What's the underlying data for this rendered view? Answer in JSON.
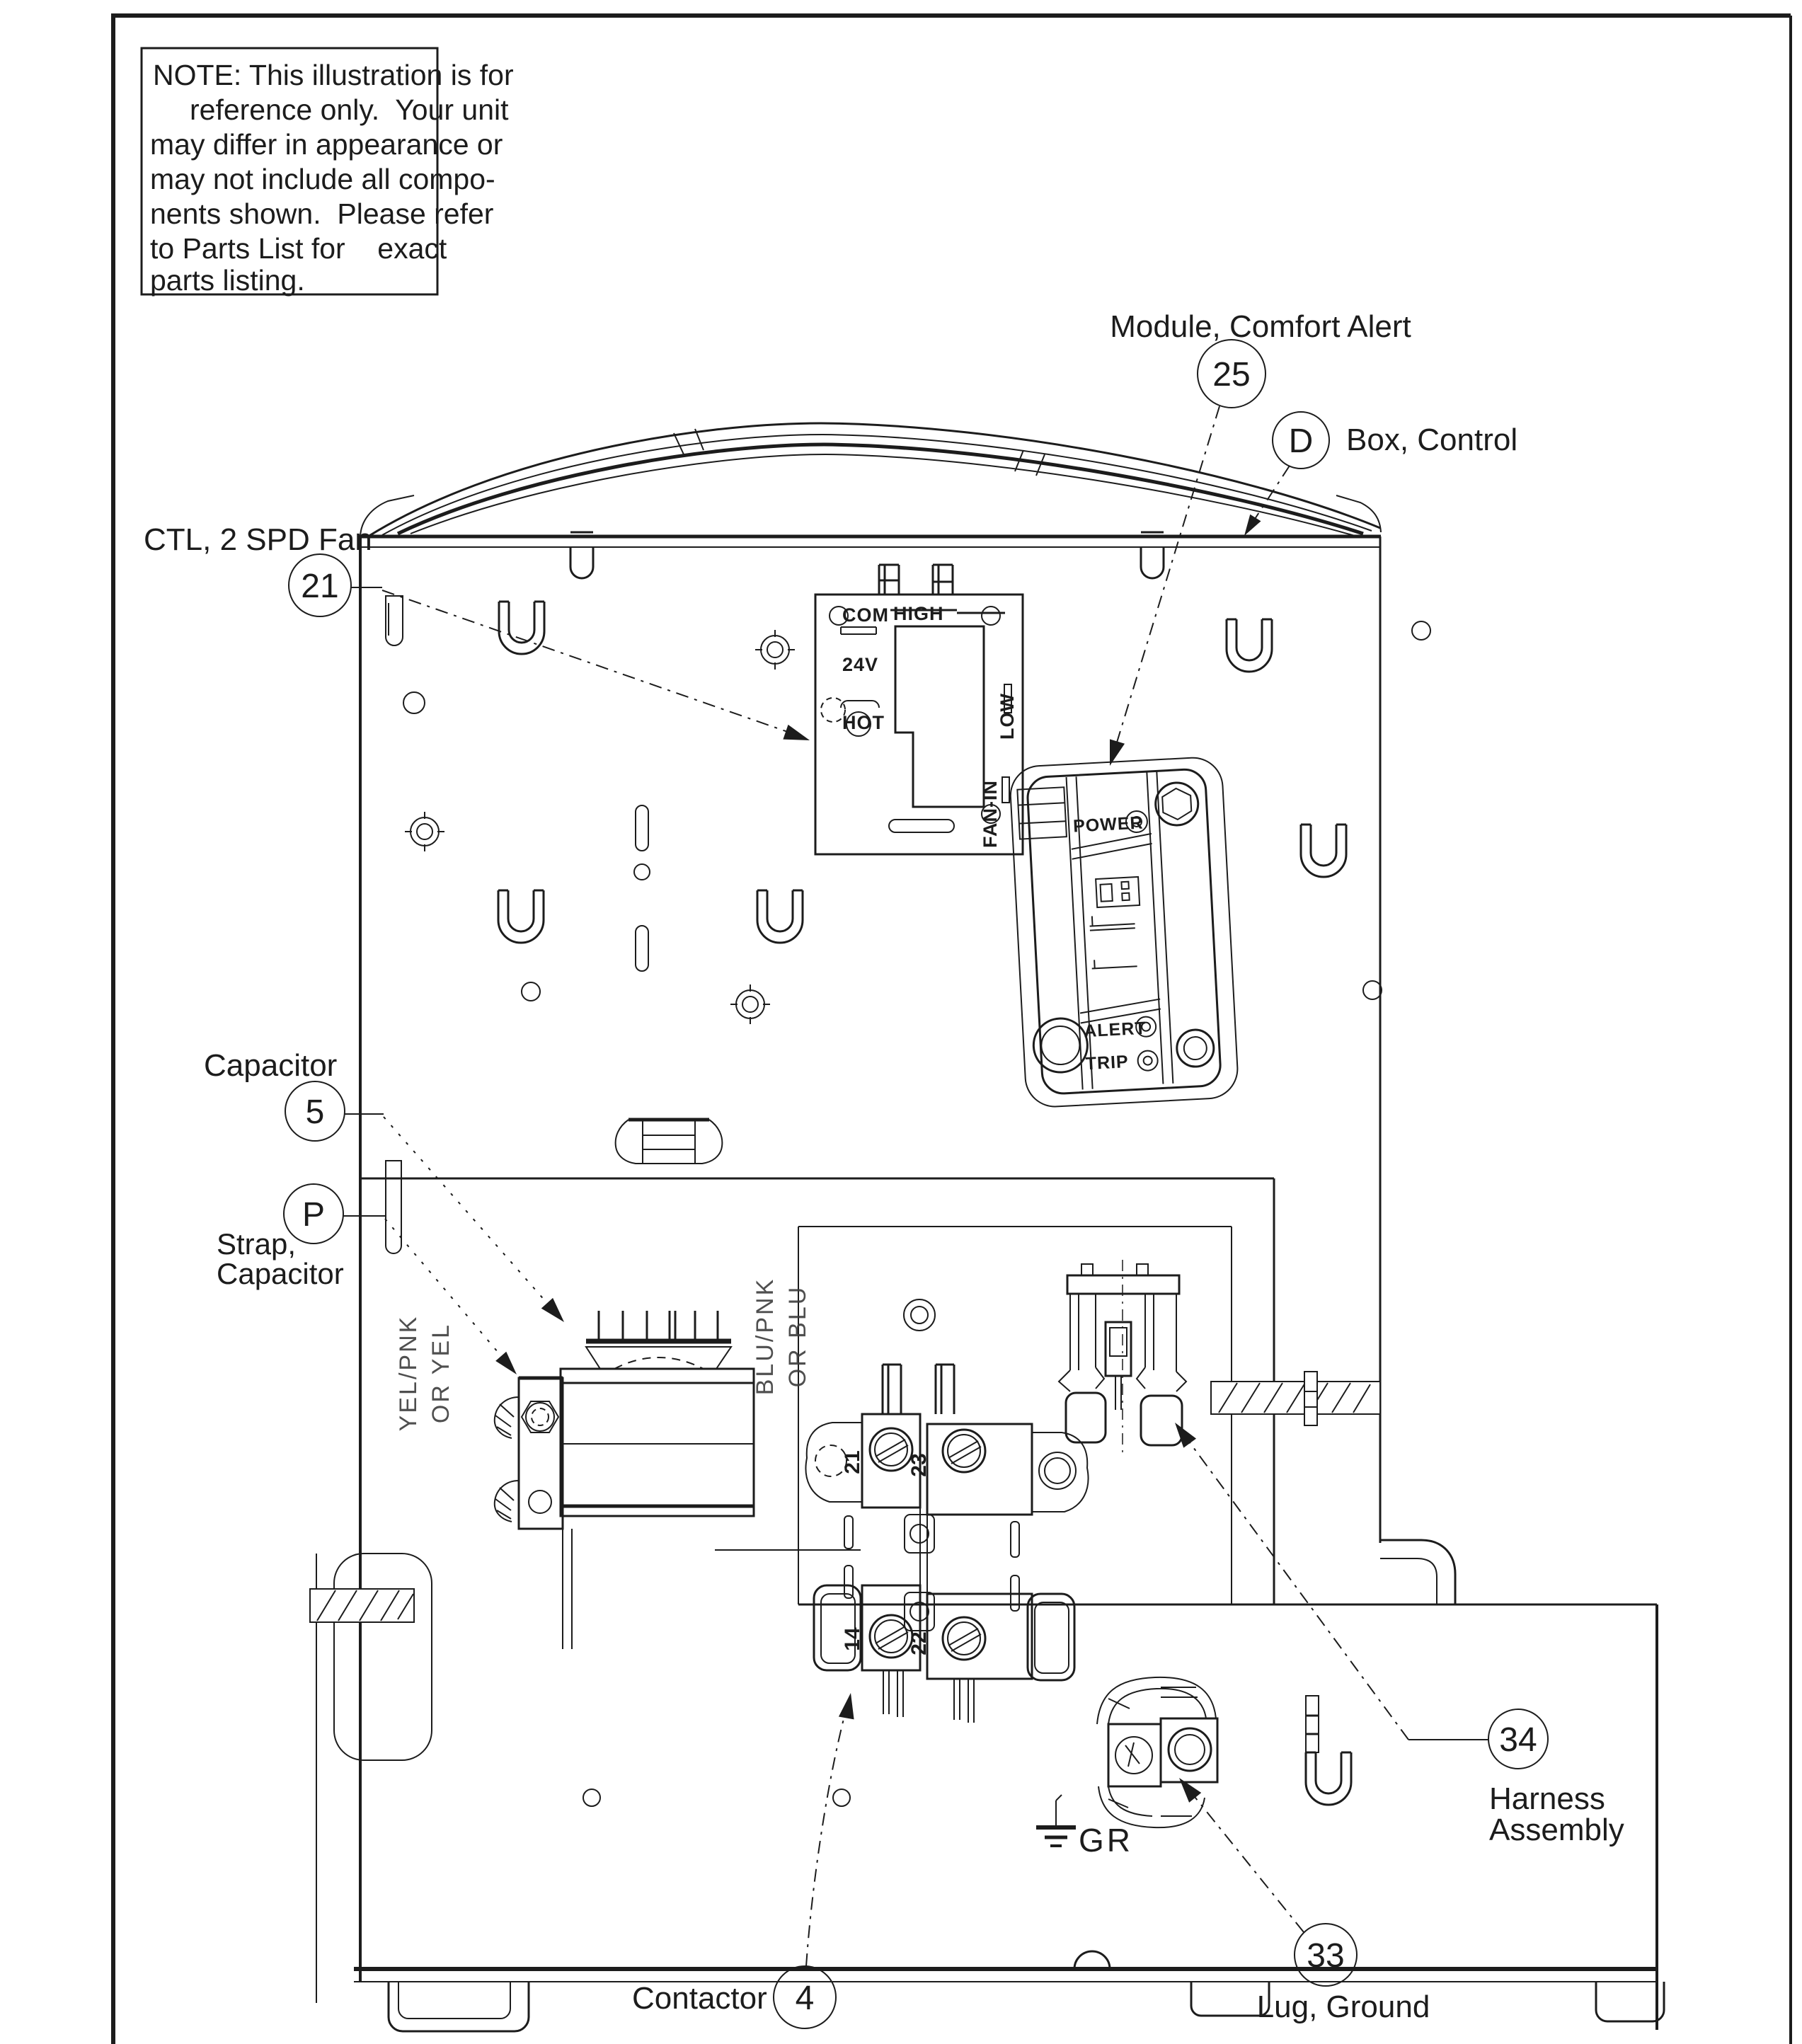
{
  "colors": {
    "ink": "#1c1c1c",
    "paper": "#ffffff"
  },
  "note": {
    "lines": [
      "NOTE: This illustration is for",
      "reference only.  Your unit",
      "may differ in appearance or",
      "may not include all compo-",
      "nents shown.  Please refer",
      "to Parts List for    exact",
      "parts listing."
    ]
  },
  "callouts": {
    "fan_control": {
      "id": "21",
      "label": "CTL, 2 SPD Fan"
    },
    "comfort_alert": {
      "id": "25",
      "label": "Module, Comfort Alert"
    },
    "control_box": {
      "id": "D",
      "label": "Box, Control"
    },
    "capacitor": {
      "id": "5",
      "label": "Capacitor"
    },
    "capacitor_strap": {
      "id": "P",
      "label_line1": "Strap,",
      "label_line2": "Capacitor"
    },
    "contactor": {
      "id": "4",
      "label": "Contactor"
    },
    "ground_lug": {
      "id": "33",
      "label": "Lug, Ground"
    },
    "harness": {
      "id": "34",
      "label_line1": "Harness",
      "label_line2": "Assembly"
    }
  },
  "fan_board_labels": {
    "com": "COM",
    "v24": "24V",
    "hot": "HOT",
    "high": "HIGH",
    "low": "LOW",
    "fan_in": "FAN-IN"
  },
  "module_labels": {
    "power": "POWER",
    "alert": "ALERT",
    "trip": "TRIP"
  },
  "wire_labels": {
    "yel1": "YEL/PNK",
    "yel2": "OR YEL",
    "blu1": "BLU/PNK",
    "blu2": "OR BLU"
  },
  "ground_label": "GR",
  "contactor_terminals": {
    "t1": "21",
    "t2": "23",
    "t3": "14",
    "t4": "22"
  }
}
